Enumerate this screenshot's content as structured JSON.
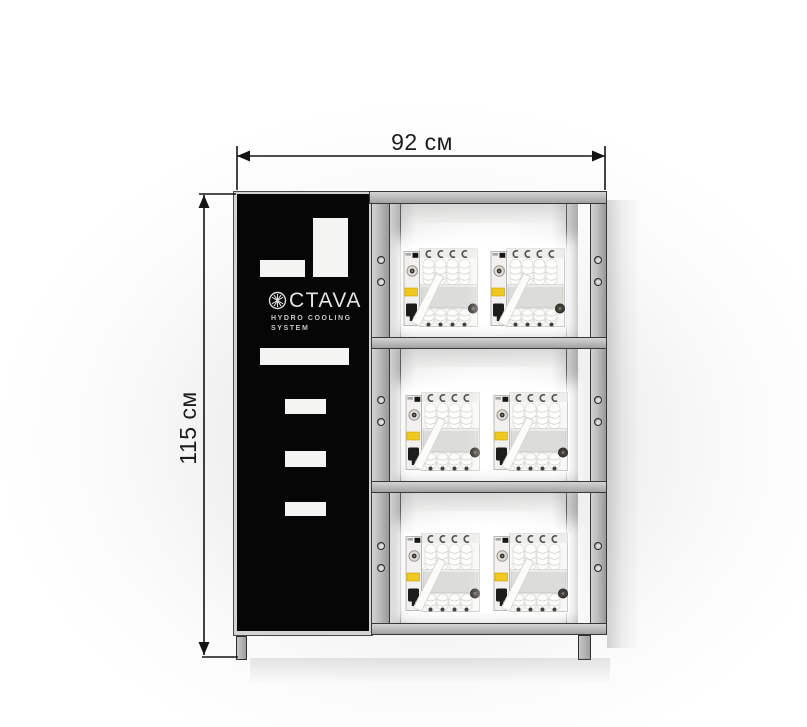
{
  "dimensions": {
    "width": "92 см",
    "height": "115 см"
  },
  "cabinet": {
    "logo": {
      "icon": "snowflake",
      "text": "CTAVA",
      "line1": "HYDRO  COOLING",
      "line2": "SYSTEM"
    }
  },
  "rack": {
    "shelf_count": 3,
    "units_per_shelf": 2,
    "units": [
      {
        "x": 403,
        "y": 248
      },
      {
        "x": 490,
        "y": 248
      },
      {
        "x": 405,
        "y": 392
      },
      {
        "x": 493,
        "y": 392
      },
      {
        "x": 405,
        "y": 533
      },
      {
        "x": 493,
        "y": 533
      }
    ]
  },
  "colors": {
    "panel_black": "#060606",
    "frame_gray": "#b9b9b9",
    "label_yellow": "#f0c81e",
    "dimension_line": "#141414"
  }
}
